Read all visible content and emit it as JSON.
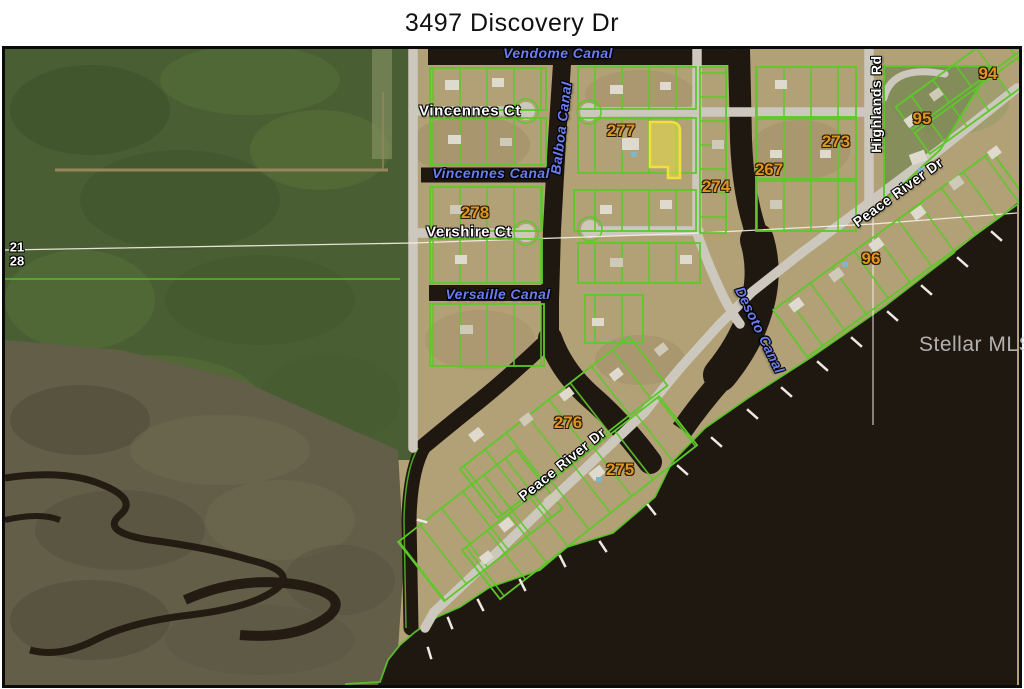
{
  "title": "3497 Discovery Dr",
  "watermark": "Stellar MLS",
  "map": {
    "canals": [
      {
        "name": "vendome-canal",
        "text": "Vendome Canal"
      },
      {
        "name": "balboa-canal",
        "text": "Balboa Canal"
      },
      {
        "name": "vincennes-canal",
        "text": "Vincennes Canal"
      },
      {
        "name": "versaille-canal",
        "text": "Versaille Canal"
      },
      {
        "name": "desoto-canal",
        "text": "Desoto Canal"
      }
    ],
    "streets": [
      {
        "name": "vincennes-ct",
        "text": "Vincennes Ct"
      },
      {
        "name": "vershire-ct",
        "text": "Vershire Ct"
      },
      {
        "name": "highlands-rd",
        "text": "Highlands Rd"
      },
      {
        "name": "peace-river-dr-upper",
        "text": "Peace River Dr"
      },
      {
        "name": "peace-river-dr-lower",
        "text": "Peace River Dr"
      }
    ],
    "parcel_numbers": [
      {
        "name": "block-277",
        "text": "277"
      },
      {
        "name": "block-278",
        "text": "278"
      },
      {
        "name": "block-274",
        "text": "274"
      },
      {
        "name": "block-267",
        "text": "267"
      },
      {
        "name": "block-273",
        "text": "273"
      },
      {
        "name": "block-94",
        "text": "94"
      },
      {
        "name": "block-95",
        "text": "95"
      },
      {
        "name": "block-96",
        "text": "96"
      },
      {
        "name": "block-276",
        "text": "276"
      },
      {
        "name": "block-275",
        "text": "275"
      }
    ],
    "section_numbers": [
      {
        "name": "section-21",
        "text": "21"
      },
      {
        "name": "section-28",
        "text": "28"
      }
    ],
    "colors": {
      "parcel_line": "#5dc829",
      "subject_parcel": "#f0e03a",
      "water": "#1f1811",
      "road": "#ccc8bd",
      "canal_label_blue": "#6b7df0",
      "parcel_number_orange": "#e09421"
    }
  }
}
